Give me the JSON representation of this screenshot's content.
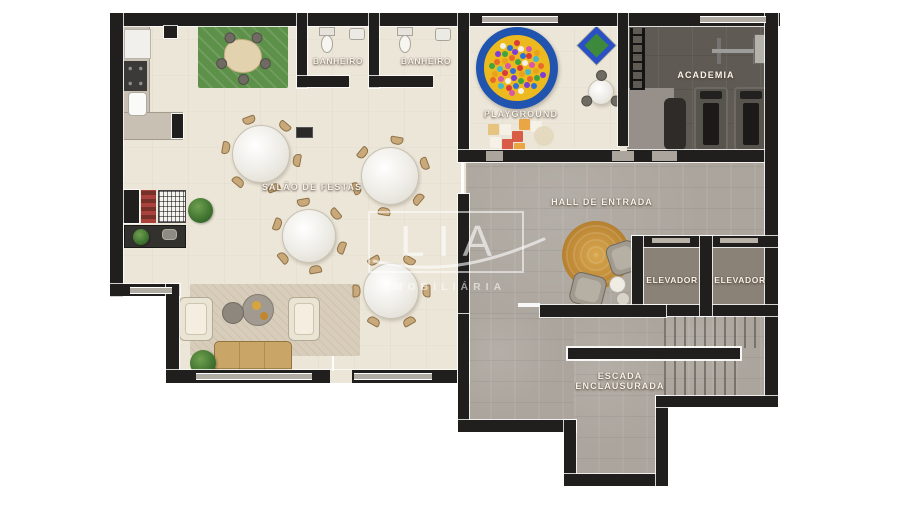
{
  "watermark": {
    "brand": "LIA",
    "subtitle": "IMOBILIÁRIA"
  },
  "rooms": {
    "salao": {
      "label": "SALÃO DE FESTAS"
    },
    "banheiro1": {
      "label": "BANHEIRO"
    },
    "banheiro2": {
      "label": "BANHEIRO"
    },
    "playground": {
      "label": "PLAYGROUND"
    },
    "academia": {
      "label": "ACADEMIA"
    },
    "hall": {
      "label": "HALL DE ENTRADA"
    },
    "elevador1": {
      "label": "ELEVADOR"
    },
    "elevador2": {
      "label": "ELEVADOR"
    },
    "escada": {
      "label_line1": "ESCADA",
      "label_line2": "ENCLAUSURADA"
    }
  },
  "colors": {
    "wall": "#201f1d",
    "floor_cream": "#ece6d8",
    "floor_concrete": "#aba59d",
    "floor_gym_dark": "#5f5a54",
    "floor_gym_light": "#97908a",
    "green_rug": "#5d9048",
    "ballpit_ring_blue": "#2154ae",
    "ballpit_yellow": "#ecba1e",
    "hall_rug_tan": "#c08a36",
    "sofa_tan": "#c9a668",
    "label_text": "#f6f3ea",
    "ball_colors": [
      "#d93b3b",
      "#2e6fd9",
      "#3da53d",
      "#e8a21c",
      "#d957a8",
      "#f5f0e6",
      "#7a3dd9",
      "#e86a2a",
      "#45b8c9"
    ],
    "mat_palette": [
      "#aace7e",
      "#e4939b",
      "#edd06e",
      "#8fc3e0",
      "#cfe0a0",
      "#e8a66b",
      "#b7d9c8",
      "#f0b8c4",
      "#d6e59a",
      "#9db8e0",
      "#eecf82",
      "#a8d4a0",
      "#e8b4a0",
      "#c0dd90",
      "#88c4d8",
      "#e09a8a",
      "#c8e0b0",
      "#f0c870",
      "#a0c8e8",
      "#d8a8b8"
    ]
  }
}
